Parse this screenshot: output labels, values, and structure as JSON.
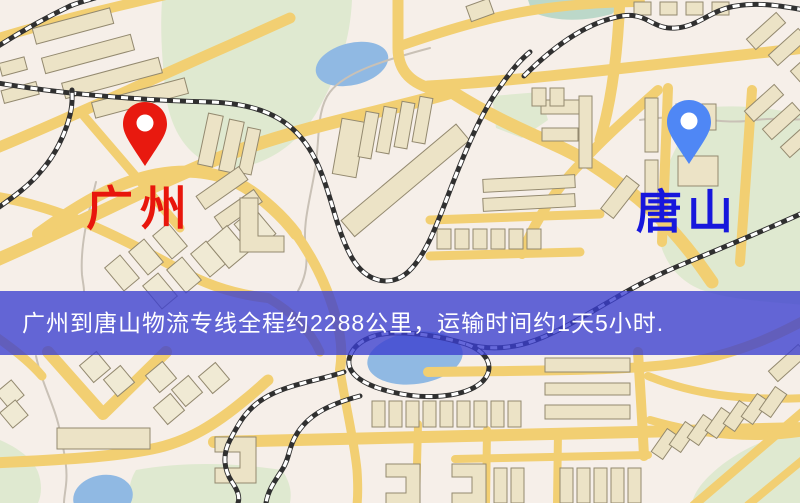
{
  "map": {
    "markers": [
      {
        "name": "guangzhou",
        "label": "广州",
        "label_color": "#e8160c",
        "pin_color": "#e8190f"
      },
      {
        "name": "tangshan",
        "label": "唐山",
        "label_color": "#1717dc",
        "pin_color": "#4f87f5"
      }
    ],
    "banner": {
      "text": "广州到唐山物流专线全程约2288公里，运输时间约1天5小时.",
      "background": "#3a3ed0",
      "text_color": "#ffffff"
    },
    "palette": {
      "land": "#f6efe9",
      "road": "#f2cf72",
      "park": "#dfe9d0",
      "water": "#90b9e3",
      "building": "#ece3c6",
      "railway": "#303030"
    }
  }
}
